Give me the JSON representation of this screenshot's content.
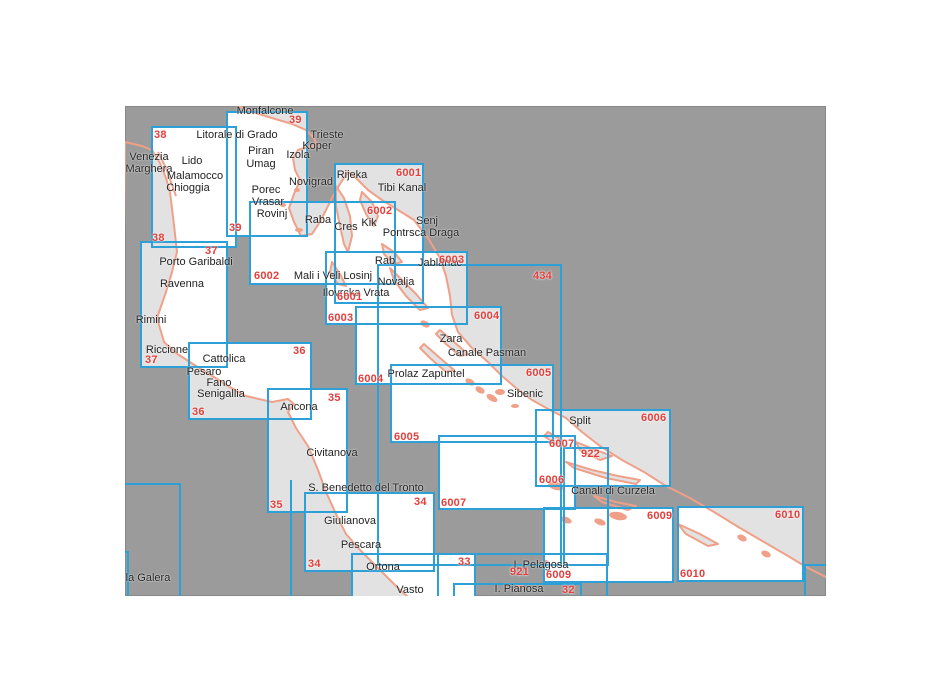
{
  "page": {
    "background": "#ffffff"
  },
  "map": {
    "x": 125,
    "y": 106,
    "width": 701,
    "height": 490,
    "colors": {
      "sea_outside": "#9b9b9b",
      "chart_fill": "#ffffff",
      "land_fill": "#e2e2e2",
      "coastline": "#f0a088",
      "border": "#2da0d8",
      "chart_number": "#e2403c",
      "place_text": "#222222"
    },
    "charts": [
      {
        "id": "38",
        "x": 26,
        "y": 20,
        "w": 86,
        "h": 122,
        "filled": true,
        "labels": [
          {
            "text": "38",
            "x": 29,
            "y": 23
          },
          {
            "text": "38",
            "x": 27,
            "y": 126
          }
        ]
      },
      {
        "id": "39",
        "x": 101,
        "y": 5,
        "w": 82,
        "h": 126,
        "filled": true,
        "labels": [
          {
            "text": "39",
            "x": 164,
            "y": 8
          },
          {
            "text": "39",
            "x": 104,
            "y": 116
          }
        ]
      },
      {
        "id": "37",
        "x": 15,
        "y": 135,
        "w": 88,
        "h": 127,
        "filled": true,
        "labels": [
          {
            "text": "37",
            "x": 80,
            "y": 139
          },
          {
            "text": "37",
            "x": 20,
            "y": 248
          }
        ]
      },
      {
        "id": "36",
        "x": 63,
        "y": 236,
        "w": 124,
        "h": 78,
        "filled": true,
        "labels": [
          {
            "text": "36",
            "x": 168,
            "y": 239
          },
          {
            "text": "36",
            "x": 67,
            "y": 300
          }
        ]
      },
      {
        "id": "35",
        "x": 142,
        "y": 282,
        "w": 81,
        "h": 125,
        "filled": true,
        "labels": [
          {
            "text": "35",
            "x": 203,
            "y": 286
          },
          {
            "text": "35",
            "x": 145,
            "y": 393
          }
        ]
      },
      {
        "id": "34",
        "x": 179,
        "y": 386,
        "w": 131,
        "h": 80,
        "filled": true,
        "labels": [
          {
            "text": "34",
            "x": 289,
            "y": 390
          },
          {
            "text": "34",
            "x": 183,
            "y": 452
          }
        ]
      },
      {
        "id": "33",
        "x": 226,
        "y": 447,
        "w": 125,
        "h": 70,
        "filled": true,
        "labels": [
          {
            "text": "33",
            "x": 333,
            "y": 450
          }
        ]
      },
      {
        "id": "6001",
        "x": 209,
        "y": 57,
        "w": 90,
        "h": 141,
        "filled": true,
        "labels": [
          {
            "text": "6001",
            "x": 271,
            "y": 61
          },
          {
            "text": "6001",
            "x": 212,
            "y": 185
          }
        ]
      },
      {
        "id": "6002",
        "x": 124,
        "y": 95,
        "w": 147,
        "h": 84,
        "filled": true,
        "labels": [
          {
            "text": "6002",
            "x": 242,
            "y": 99
          },
          {
            "text": "6002",
            "x": 129,
            "y": 164
          }
        ]
      },
      {
        "id": "6003",
        "x": 200,
        "y": 145,
        "w": 143,
        "h": 74,
        "filled": true,
        "labels": [
          {
            "text": "6003",
            "x": 314,
            "y": 148
          },
          {
            "text": "6003",
            "x": 203,
            "y": 206
          }
        ]
      },
      {
        "id": "6004",
        "x": 230,
        "y": 200,
        "w": 147,
        "h": 79,
        "filled": true,
        "labels": [
          {
            "text": "6004",
            "x": 349,
            "y": 204
          },
          {
            "text": "6004",
            "x": 233,
            "y": 267
          }
        ]
      },
      {
        "id": "6005",
        "x": 265,
        "y": 258,
        "w": 164,
        "h": 79,
        "filled": true,
        "labels": [
          {
            "text": "6005",
            "x": 401,
            "y": 261
          },
          {
            "text": "6005",
            "x": 269,
            "y": 325
          }
        ]
      },
      {
        "id": "6006",
        "x": 410,
        "y": 303,
        "w": 136,
        "h": 78,
        "filled": true,
        "labels": [
          {
            "text": "6006",
            "x": 516,
            "y": 306
          },
          {
            "text": "6006",
            "x": 414,
            "y": 368
          }
        ]
      },
      {
        "id": "6007",
        "x": 313,
        "y": 329,
        "w": 138,
        "h": 75,
        "filled": true,
        "labels": [
          {
            "text": "6007",
            "x": 424,
            "y": 332
          },
          {
            "text": "6007",
            "x": 316,
            "y": 391
          }
        ]
      },
      {
        "id": "6009",
        "x": 418,
        "y": 401,
        "w": 131,
        "h": 76,
        "filled": true,
        "labels": [
          {
            "text": "6009",
            "x": 522,
            "y": 404
          },
          {
            "text": "6009",
            "x": 421,
            "y": 463
          }
        ]
      },
      {
        "id": "6010",
        "x": 552,
        "y": 400,
        "w": 127,
        "h": 76,
        "filled": true,
        "labels": [
          {
            "text": "6010",
            "x": 650,
            "y": 403
          },
          {
            "text": "6010",
            "x": 555,
            "y": 462
          }
        ]
      },
      {
        "id": "434",
        "x": 252,
        "y": 158,
        "w": 185,
        "h": 302,
        "filled": false,
        "labels": [
          {
            "text": "434",
            "x": 408,
            "y": 164
          }
        ]
      },
      {
        "id": "922",
        "x": 438,
        "y": 341,
        "w": 46,
        "h": 119,
        "filled": false,
        "labels": [
          {
            "text": "922",
            "x": 456,
            "y": 342
          }
        ]
      },
      {
        "id": "921",
        "x": 312,
        "y": 447,
        "w": 171,
        "h": 60,
        "filled": false,
        "labels": [
          {
            "text": "921",
            "x": 385,
            "y": 460
          }
        ]
      },
      {
        "id": "32",
        "x": 328,
        "y": 477,
        "w": 129,
        "h": 40,
        "filled": false,
        "labels": [
          {
            "text": "32",
            "x": 437,
            "y": 478
          }
        ]
      },
      {
        "id": "edge-box-a",
        "x": -30,
        "y": 377,
        "w": 86,
        "h": 140,
        "filled": false,
        "labels": []
      },
      {
        "id": "edge-box-b",
        "x": -30,
        "y": 445,
        "w": 34,
        "h": 86,
        "filled": false,
        "labels": []
      },
      {
        "id": "edge-box-c",
        "x": 679,
        "y": 458,
        "w": 60,
        "h": 92,
        "filled": false,
        "labels": []
      }
    ],
    "segments": [
      {
        "id": "boundary-segment",
        "x": 165,
        "y": 374,
        "w": 2,
        "h": 116
      }
    ],
    "places": [
      {
        "text": "Monfalcone",
        "x": 140,
        "y": 5
      },
      {
        "text": "Litorale di Grado",
        "x": 112,
        "y": 29
      },
      {
        "text": "Trieste",
        "x": 202,
        "y": 29
      },
      {
        "text": "Koper",
        "x": 192,
        "y": 40
      },
      {
        "text": "Izola",
        "x": 173,
        "y": 49
      },
      {
        "text": "Piran",
        "x": 136,
        "y": 45
      },
      {
        "text": "Umag",
        "x": 136,
        "y": 58
      },
      {
        "text": "Venezia",
        "x": 24,
        "y": 51
      },
      {
        "text": "Marghera",
        "x": 24,
        "y": 63
      },
      {
        "text": "Lido",
        "x": 67,
        "y": 55
      },
      {
        "text": "Malamocco",
        "x": 70,
        "y": 70
      },
      {
        "text": "Chioggia",
        "x": 63,
        "y": 82
      },
      {
        "text": "Novigrad",
        "x": 186,
        "y": 76
      },
      {
        "text": "Porec",
        "x": 141,
        "y": 84
      },
      {
        "text": "Vrasar",
        "x": 143,
        "y": 96
      },
      {
        "text": "Rovinj",
        "x": 147,
        "y": 108
      },
      {
        "text": "Rijeka",
        "x": 227,
        "y": 69
      },
      {
        "text": "Tibi Kanal",
        "x": 277,
        "y": 82
      },
      {
        "text": "Raba",
        "x": 193,
        "y": 114
      },
      {
        "text": "Cres",
        "x": 221,
        "y": 121
      },
      {
        "text": "Kik",
        "x": 244,
        "y": 117
      },
      {
        "text": "Senj",
        "x": 302,
        "y": 115
      },
      {
        "text": "Pontrsca Draga",
        "x": 296,
        "y": 127
      },
      {
        "text": "Rab",
        "x": 260,
        "y": 155
      },
      {
        "text": "Jablanac",
        "x": 315,
        "y": 157
      },
      {
        "text": "Porto Garibaldi",
        "x": 71,
        "y": 156
      },
      {
        "text": "Ravenna",
        "x": 57,
        "y": 178
      },
      {
        "text": "Rimini",
        "x": 26,
        "y": 214
      },
      {
        "text": "Riccione",
        "x": 42,
        "y": 244
      },
      {
        "text": "Mali i Veli Losinj",
        "x": 208,
        "y": 170
      },
      {
        "text": "Novalja",
        "x": 271,
        "y": 176
      },
      {
        "text": "Ilovrcka Vrata",
        "x": 231,
        "y": 187
      },
      {
        "text": "Cattolica",
        "x": 99,
        "y": 253
      },
      {
        "text": "Pesaro",
        "x": 79,
        "y": 266
      },
      {
        "text": "Fano",
        "x": 94,
        "y": 277
      },
      {
        "text": "Senigallia",
        "x": 96,
        "y": 288
      },
      {
        "text": "Ancona",
        "x": 174,
        "y": 301
      },
      {
        "text": "Zara",
        "x": 326,
        "y": 233
      },
      {
        "text": "Canale Pasman",
        "x": 362,
        "y": 247
      },
      {
        "text": "Prolaz Zapuntel",
        "x": 301,
        "y": 268
      },
      {
        "text": "Sibenic",
        "x": 400,
        "y": 288
      },
      {
        "text": "Split",
        "x": 455,
        "y": 315
      },
      {
        "text": "Civitanova",
        "x": 207,
        "y": 347
      },
      {
        "text": "S. Benedetto del Tronto",
        "x": 241,
        "y": 382
      },
      {
        "text": "Canali di Curzela",
        "x": 488,
        "y": 385
      },
      {
        "text": "Giulianova",
        "x": 225,
        "y": 415
      },
      {
        "text": "Pescara",
        "x": 236,
        "y": 439
      },
      {
        "text": "Ortona",
        "x": 258,
        "y": 461
      },
      {
        "text": "Vasto",
        "x": 285,
        "y": 484
      },
      {
        "text": "I. Pelagosa",
        "x": 416,
        "y": 459
      },
      {
        "text": "I. Pianosa",
        "x": 394,
        "y": 483
      },
      {
        "text": "la Galera",
        "x": 23,
        "y": 472
      }
    ],
    "geometry": {
      "landmasses": [
        {
          "name": "italy-mainland",
          "path": "M 0,36 L 17,40 L 27,44 L 35,57 L 41,72 L 45,86 L 49,119 L 52,146 L 47,166 L 41,186 L 32,212 L 39,236 L 51,247 L 71,260 L 89,271 L 103,280 L 121,290 L 147,296 L 163,293 L 169,298 L 163,306 L 171,322 L 183,340 L 193,364 L 201,386 L 211,408 L 221,428 L 237,446 L 251,460 L 265,474 L 275,484 L 283,491 L 283,496 L -5,496 Z"
        },
        {
          "name": "istria-croatia-mainland",
          "path": "M 113,0 L 127,6 L 147,12 L 167,18 L 181,24 L 189,32 L 192,40 L 183,41 L 173,44 L 168,52 L 170,64 L 175,74 L 169,88 L 164,102 L 169,116 L 176,130 L 187,128 L 195,116 L 202,102 L 208,90 L 215,78 L 223,66 L 231,72 L 243,84 L 257,94 L 273,104 L 289,114 L 303,132 L 315,152 L 321,170 L 325,190 L 327,209 L 333,226 L 347,242 L 363,256 L 377,270 L 391,282 L 407,294 L 425,304 L 441,312 L 457,326 L 475,340 L 497,354 L 519,366 L 541,380 L 565,392 L 589,406 L 615,422 L 639,436 L 663,450 L 683,462 L 703,472 L 703,-6 L 113,-6 Z"
        }
      ],
      "islands": [
        {
          "name": "cres",
          "path": "M 211,80 L 219,92 L 225,110 L 227,130 L 223,146 L 219,138 L 215,120 L 211,100 Z"
        },
        {
          "name": "krk",
          "path": "M 237,86 L 247,96 L 253,110 L 249,120 L 241,108 L 235,94 Z"
        },
        {
          "name": "rab",
          "path": "M 257,138 L 269,146 L 277,156 L 269,158 L 259,148 Z"
        },
        {
          "name": "losinj",
          "path": "M 207,156 L 215,168 L 221,180 L 213,178 L 205,166 Z"
        },
        {
          "name": "pag",
          "path": "M 265,162 L 277,174 L 291,188 L 303,202 L 295,204 L 281,190 L 269,174 Z"
        },
        {
          "name": "ugljan-pasman",
          "path": "M 315,224 L 329,236 L 343,248 L 335,250 L 321,238 L 311,228 Z"
        },
        {
          "name": "dugi-otok",
          "path": "M 299,238 L 315,252 L 329,264 L 321,266 L 305,252 L 295,242 Z"
        },
        {
          "name": "solta",
          "path": "M 423,326 L 437,334 L 431,338 L 419,330 Z"
        },
        {
          "name": "brac",
          "path": "M 451,336 L 471,344 L 487,350 L 475,354 L 455,344 Z"
        },
        {
          "name": "hvar",
          "path": "M 441,356 L 467,364 L 493,370 L 515,374 L 511,378 L 481,372 L 449,362 Z"
        },
        {
          "name": "korcula",
          "path": "M 469,390 L 491,396 L 511,400 L 503,404 L 477,396 Z"
        },
        {
          "name": "mljet",
          "path": "M 553,418 L 575,428 L 593,438 L 583,440 L 561,428 Z"
        }
      ],
      "islets": [
        {
          "cx": 345,
          "cy": 276,
          "rx": 5,
          "ry": 3,
          "rot": 30
        },
        {
          "cx": 355,
          "cy": 284,
          "rx": 5,
          "ry": 3,
          "rot": 30
        },
        {
          "cx": 367,
          "cy": 292,
          "rx": 6,
          "ry": 3,
          "rot": 30
        },
        {
          "cx": 375,
          "cy": 286,
          "rx": 5,
          "ry": 3,
          "rot": 0
        },
        {
          "cx": 390,
          "cy": 300,
          "rx": 4,
          "ry": 2,
          "rot": 0
        },
        {
          "cx": 300,
          "cy": 218,
          "rx": 5,
          "ry": 3,
          "rot": 30
        },
        {
          "cx": 431,
          "cy": 380,
          "rx": 8,
          "ry": 4,
          "rot": 15
        },
        {
          "cx": 493,
          "cy": 410,
          "rx": 9,
          "ry": 4,
          "rot": 10
        },
        {
          "cx": 441,
          "cy": 414,
          "rx": 6,
          "ry": 3,
          "rot": 20
        },
        {
          "cx": 475,
          "cy": 416,
          "rx": 6,
          "ry": 3,
          "rot": 20
        },
        {
          "cx": 420,
          "cy": 456,
          "rx": 4,
          "ry": 2,
          "rot": 0
        },
        {
          "cx": 395,
          "cy": 480,
          "rx": 4,
          "ry": 2,
          "rot": 0
        },
        {
          "cx": 172,
          "cy": 84,
          "rx": 3,
          "ry": 2,
          "rot": 0
        },
        {
          "cx": 158,
          "cy": 99,
          "rx": 3,
          "ry": 2,
          "rot": 0
        },
        {
          "cx": 174,
          "cy": 124,
          "rx": 4,
          "ry": 2,
          "rot": 0
        },
        {
          "cx": 617,
          "cy": 432,
          "rx": 5,
          "ry": 3,
          "rot": 25
        },
        {
          "cx": 641,
          "cy": 448,
          "rx": 5,
          "ry": 3,
          "rot": 25
        }
      ],
      "lines": [
        {
          "name": "venice-lido-barrier",
          "path": "M 33,46 L 41,62 L 47,79 L 51,90"
        }
      ]
    }
  }
}
